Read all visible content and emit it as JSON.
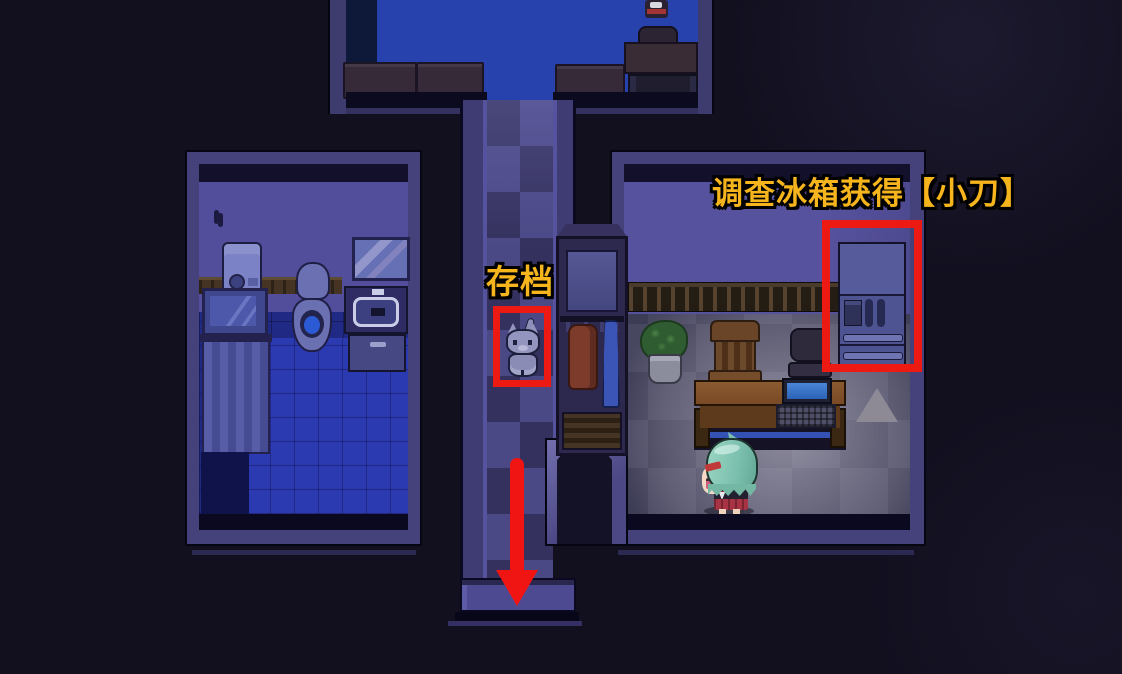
{
  "scene": {
    "description": "Top-down pixel-art RPG interior at night: bedroom at top, bathroom at left, living room with kitchen corner at right, connected by a tiled corridor",
    "background_color": "#12101f"
  },
  "annotations": {
    "fridge_hint": {
      "text": "调查冰箱获得【小刀】"
    },
    "save_label": {
      "text": "存档"
    },
    "style": {
      "text_color": "#f6b41d",
      "outline_color": "#000000",
      "box_color": "#ec1a13",
      "arrow_color": "#f01512"
    },
    "arrow": {
      "direction": "down"
    }
  },
  "rooms": {
    "top_room": {
      "objects": [
        "sofa-left",
        "sofa-middle",
        "sofa-right",
        "chair",
        "desk",
        "bench",
        "small-figure"
      ]
    },
    "bathroom": {
      "objects": [
        "wall-hook",
        "washing-machine",
        "wall-mirror",
        "toilet",
        "sink",
        "sink-cabinet",
        "bathtub",
        "shower-curtain"
      ]
    },
    "living_room": {
      "objects": [
        "coat-stand",
        "red-coat",
        "blue-umbrella",
        "wall-shelf",
        "refrigerator",
        "potted-plant",
        "wooden-chair",
        "office-chair",
        "desk",
        "laptop",
        "triangle-marker",
        "player-character"
      ]
    },
    "corridor": {
      "objects": [
        "save-point-creature"
      ]
    }
  },
  "player": {
    "appearance": "girl with teal bob hair, red hairpin, dark jacket, red skirt, facing left"
  },
  "save_point": {
    "appearance": "small grey cat-like creature"
  }
}
